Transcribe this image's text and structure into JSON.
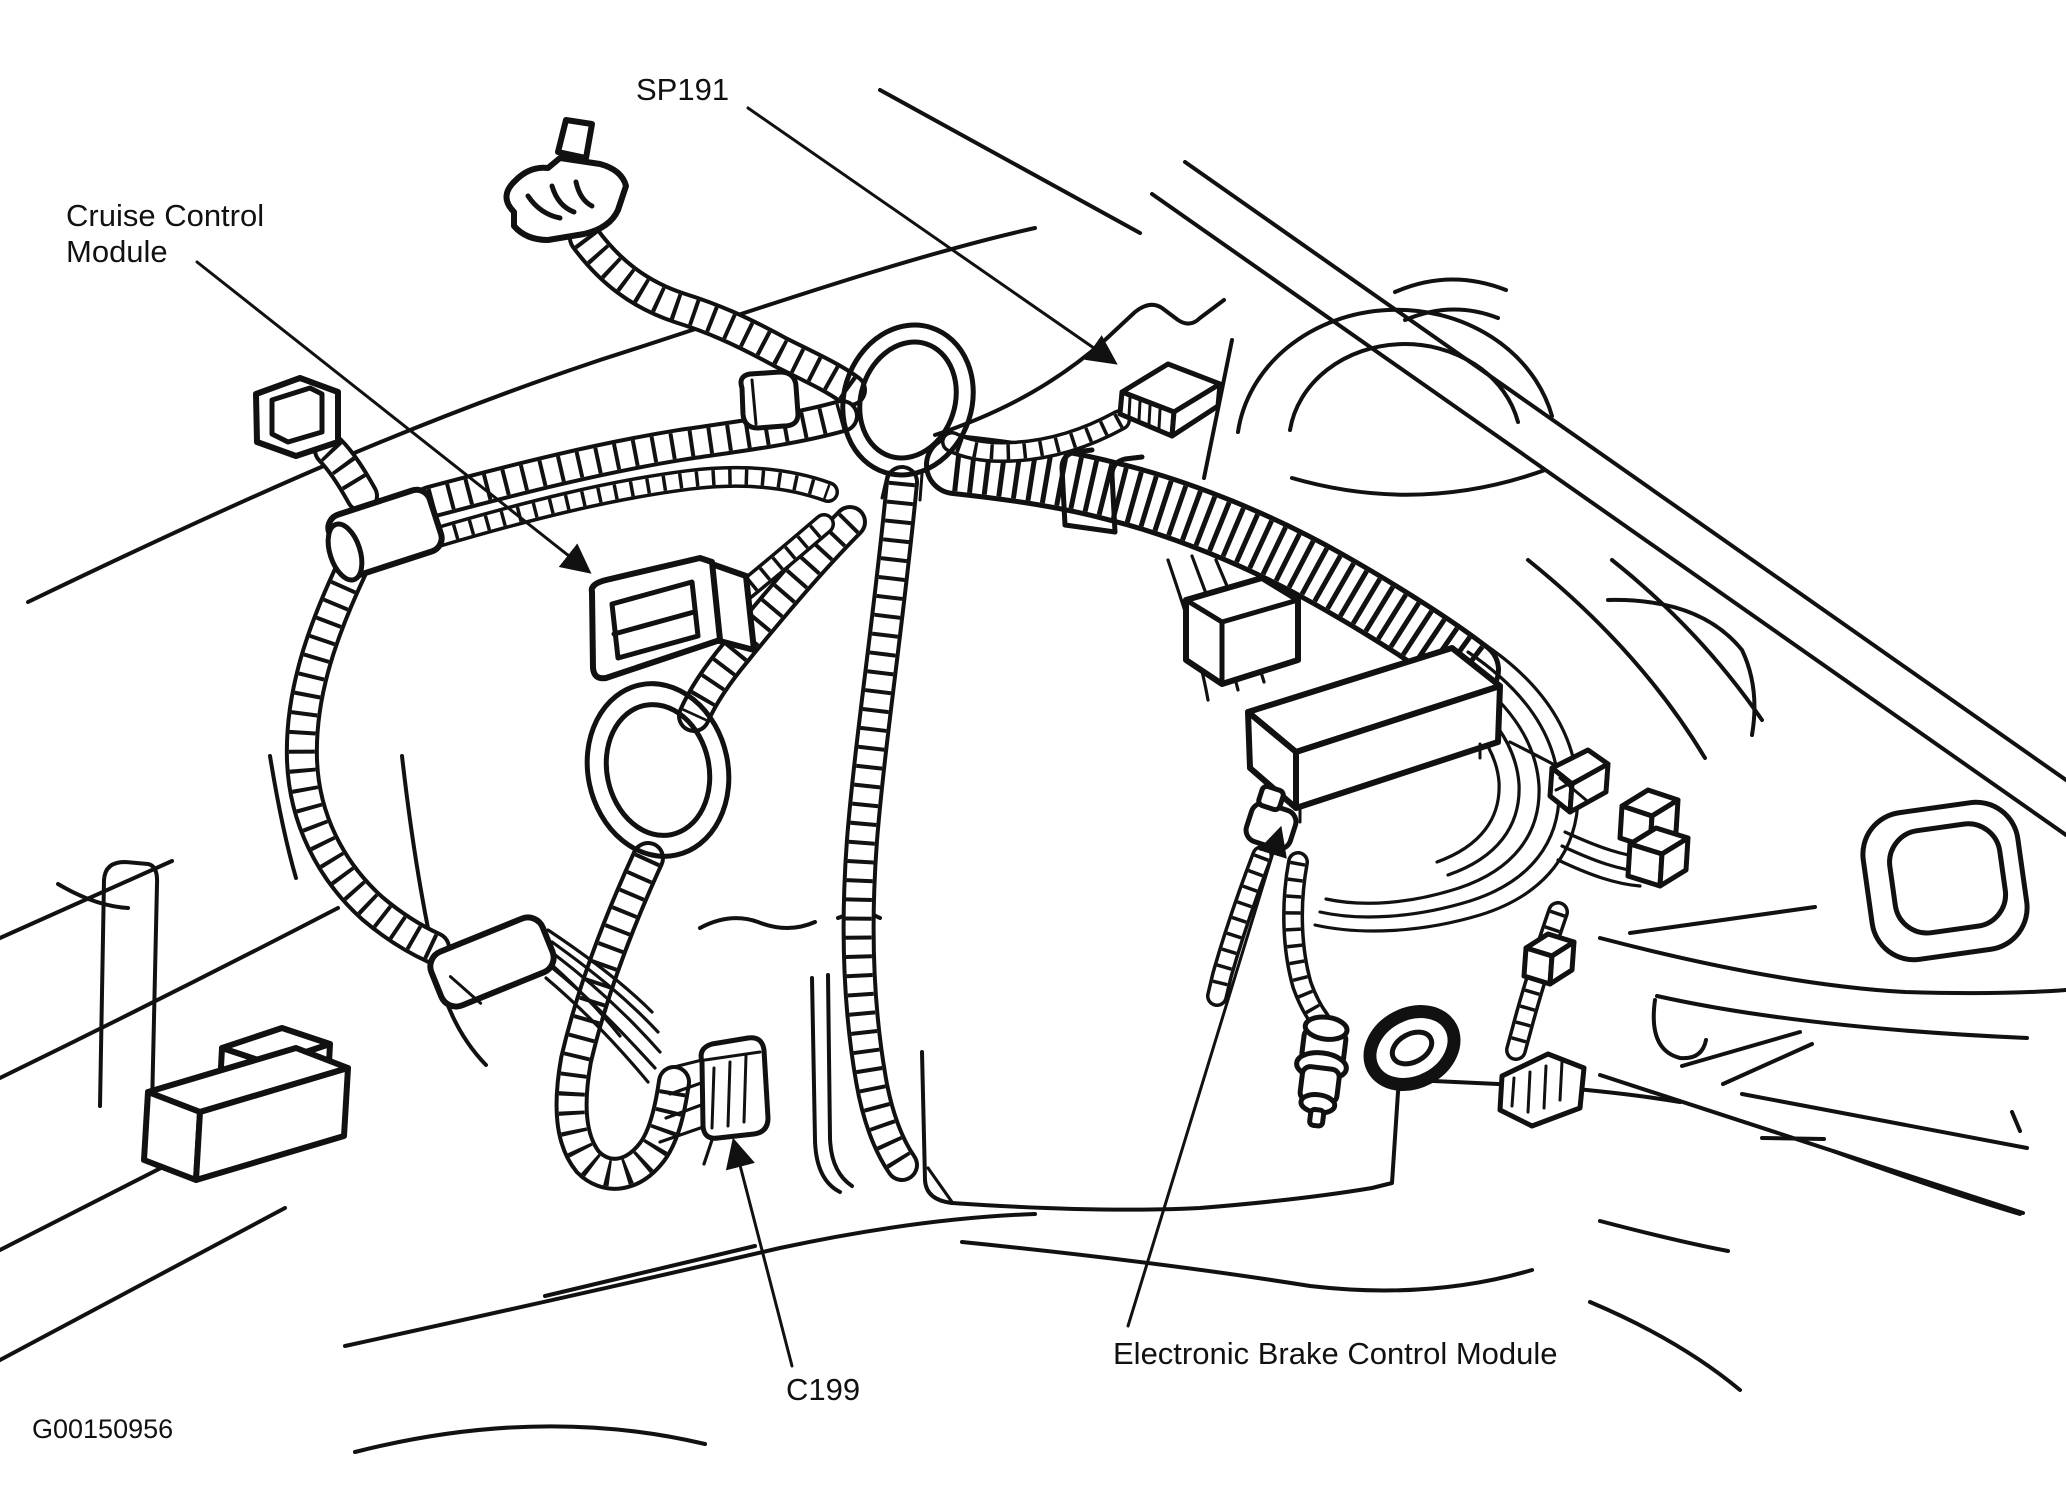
{
  "figure": {
    "code": "G00150956",
    "ink_color": "#111111",
    "background_color": "#ffffff"
  },
  "labels": {
    "cruise_control_module": {
      "line1": "Cruise Control",
      "line2": "Module"
    },
    "sp191": {
      "text": "SP191"
    },
    "c199": {
      "text": "C199"
    },
    "electronic_brake_control_module": {
      "text": "Electronic Brake Control Module"
    }
  }
}
